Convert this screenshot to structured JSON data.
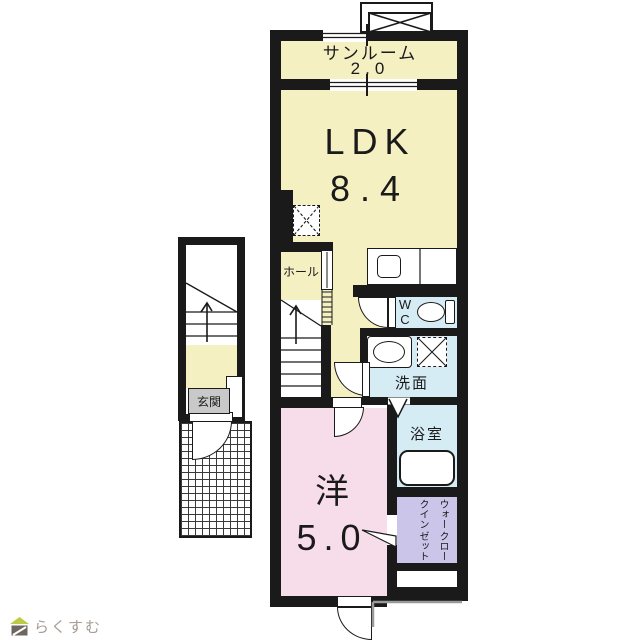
{
  "floorplan": {
    "type": "apartment-floor-plan",
    "rooms": {
      "sunroom": {
        "label": "サンルーム",
        "size": "2.0"
      },
      "ldk": {
        "label": "LDK",
        "size": "8.4"
      },
      "hall": {
        "label": "ホール"
      },
      "wc": {
        "label_line1": "W",
        "label_line2": "C"
      },
      "washroom": {
        "label": "洗面"
      },
      "bathroom": {
        "label": "浴室"
      },
      "western_room": {
        "label": "洋",
        "size": "5.0"
      },
      "walk_in_closet": {
        "label_col1": "ウォークイン",
        "label_col2": "クローゼット"
      },
      "entrance": {
        "label": "玄関"
      }
    },
    "colors": {
      "room_cream": "#f5f0c2",
      "room_pink": "#f7dde9",
      "room_blue": "#d6ecf5",
      "room_lavender": "#cbc5ea",
      "entrance_gray": "#c9c9c9",
      "wall_black": "#1a1a1a",
      "balcony_gray": "#999999"
    }
  },
  "branding": {
    "logo_text": "らくすむ",
    "logo_roof_color": "#bccb45",
    "logo_body_color": "#6e6760"
  }
}
